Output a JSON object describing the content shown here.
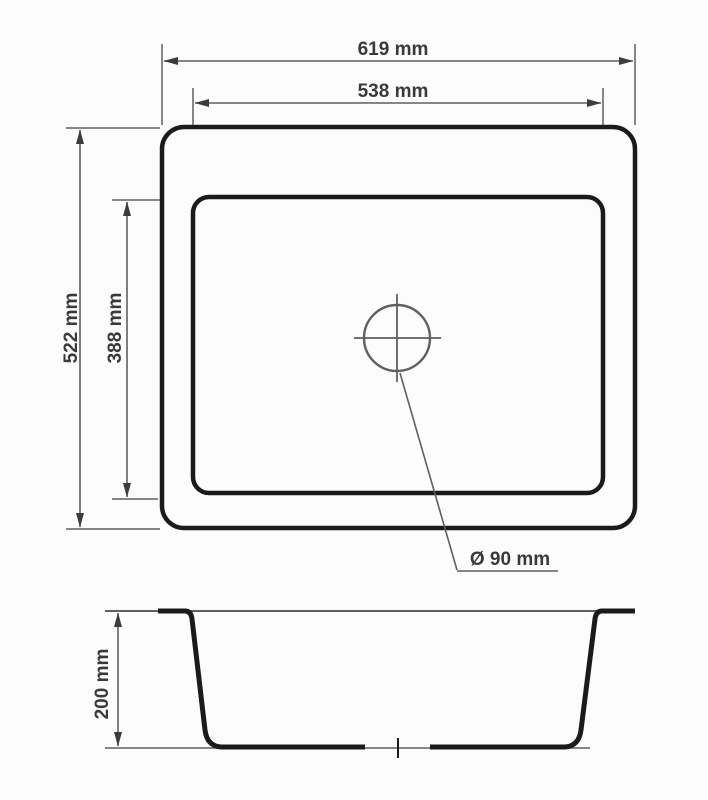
{
  "diagram": {
    "kind": "technical-dimension-drawing",
    "subject": "rectangular kitchen sink, top view and cross-section",
    "units": "mm",
    "colors": {
      "background": "#fcfcfc",
      "outline": "#1b1b1b",
      "dimension": "#5f5f5f",
      "arrow": "#3c3c3c",
      "label": "#3a3a3a"
    },
    "top_view": {
      "dimensions": [
        {
          "id": "outer-width",
          "label": "619 mm",
          "value": 619
        },
        {
          "id": "inner-width",
          "label": "538 mm",
          "value": 538
        },
        {
          "id": "outer-depth",
          "label": "522 mm",
          "value": 522
        },
        {
          "id": "inner-depth",
          "label": "388 mm",
          "value": 388
        },
        {
          "id": "drain-diameter",
          "label": "Ø 90 mm",
          "value": 90
        }
      ]
    },
    "section_view": {
      "dimensions": [
        {
          "id": "bowl-depth",
          "label": "200 mm",
          "value": 200
        }
      ]
    }
  }
}
